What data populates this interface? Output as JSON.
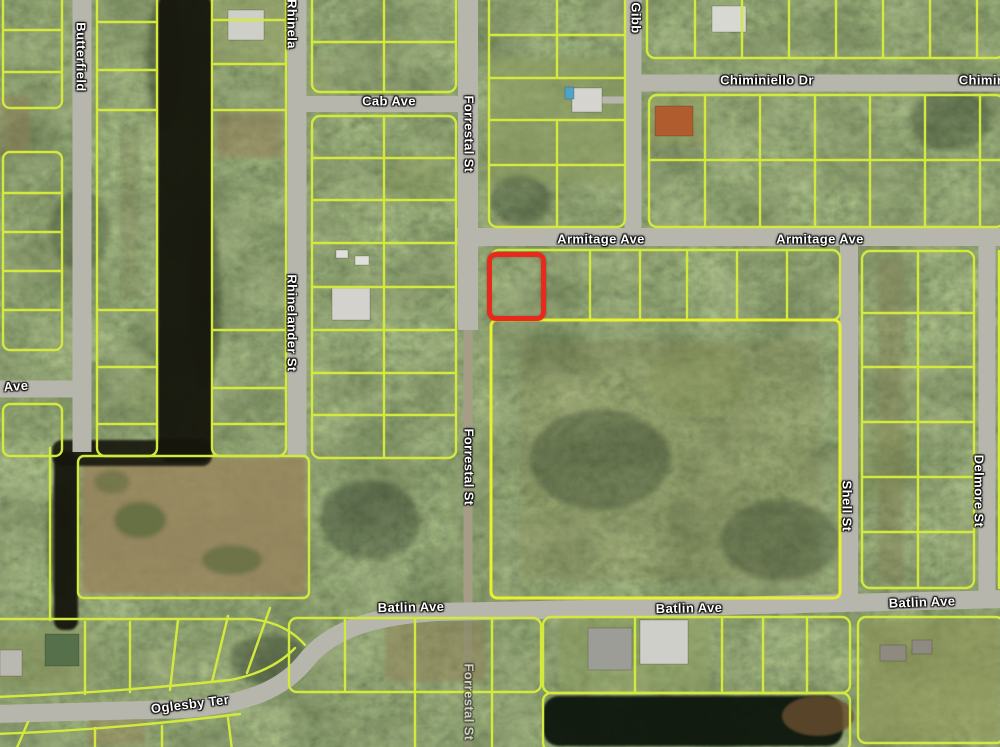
{
  "map": {
    "kind": "satellite-parcel-map",
    "highlight": {
      "x": 487,
      "y": 252,
      "width": 59,
      "height": 69,
      "color": "#e8291c"
    },
    "street_labels": [
      {
        "id": "butterfield",
        "text": "Butterfield",
        "x": 81,
        "y": 57,
        "rotation": 90
      },
      {
        "id": "rhinelander-top",
        "text": "Rhinela",
        "x": 292,
        "y": 24,
        "rotation": 90
      },
      {
        "id": "cab-ave",
        "text": "Cab Ave",
        "x": 389,
        "y": 101,
        "rotation": 0
      },
      {
        "id": "forrestal-top",
        "text": "Forrestal St",
        "x": 469,
        "y": 134,
        "rotation": 90
      },
      {
        "id": "gibb",
        "text": "Gibb",
        "x": 636,
        "y": 18,
        "rotation": 90
      },
      {
        "id": "chiminiello-dr",
        "text": "Chiminiello Dr",
        "x": 767,
        "y": 80,
        "rotation": 0
      },
      {
        "id": "chiminiello-right",
        "text": "Chimin",
        "x": 982,
        "y": 80,
        "rotation": 0
      },
      {
        "id": "armitage-ave-1",
        "text": "Armitage Ave",
        "x": 601,
        "y": 239,
        "rotation": 0
      },
      {
        "id": "armitage-ave-2",
        "text": "Armitage Ave",
        "x": 820,
        "y": 239,
        "rotation": 0
      },
      {
        "id": "ave-left-edge",
        "text": "Ave",
        "x": 16,
        "y": 386,
        "rotation": -4
      },
      {
        "id": "rhinelander-mid",
        "text": "Rhinelander St",
        "x": 292,
        "y": 323,
        "rotation": 90
      },
      {
        "id": "forrestal-mid",
        "text": "Forrestal St",
        "x": 469,
        "y": 467,
        "rotation": 90
      },
      {
        "id": "shell-st",
        "text": "Shell St",
        "x": 847,
        "y": 506,
        "rotation": 90
      },
      {
        "id": "delmore-st",
        "text": "Delmore St",
        "x": 979,
        "y": 491,
        "rotation": 90
      },
      {
        "id": "batlin-ave-1",
        "text": "Batlin Ave",
        "x": 411,
        "y": 607,
        "rotation": -1
      },
      {
        "id": "batlin-ave-2",
        "text": "Batlin Ave",
        "x": 689,
        "y": 608,
        "rotation": -1
      },
      {
        "id": "batlin-ave-3",
        "text": "Batlin Ave",
        "x": 922,
        "y": 602,
        "rotation": -2
      },
      {
        "id": "oglesby-ter",
        "text": "Oglesby Ter",
        "x": 190,
        "y": 704,
        "rotation": -7
      },
      {
        "id": "forrestal-bottom",
        "text": "Forrestal St",
        "x": 469,
        "y": 702,
        "rotation": 90,
        "opacity": 0.55
      }
    ],
    "colors": {
      "parcel_line": "#d3ea3c",
      "parcel_line_bold": "#e9f02e",
      "road": "#b6b6ad",
      "dirt_road": "#a59d86",
      "water": "#12170d",
      "vegetation_base": "#3c4a28",
      "cleared_land": "#97835c",
      "highlight_red": "#e8291c",
      "label_text": "#ffffff"
    }
  }
}
